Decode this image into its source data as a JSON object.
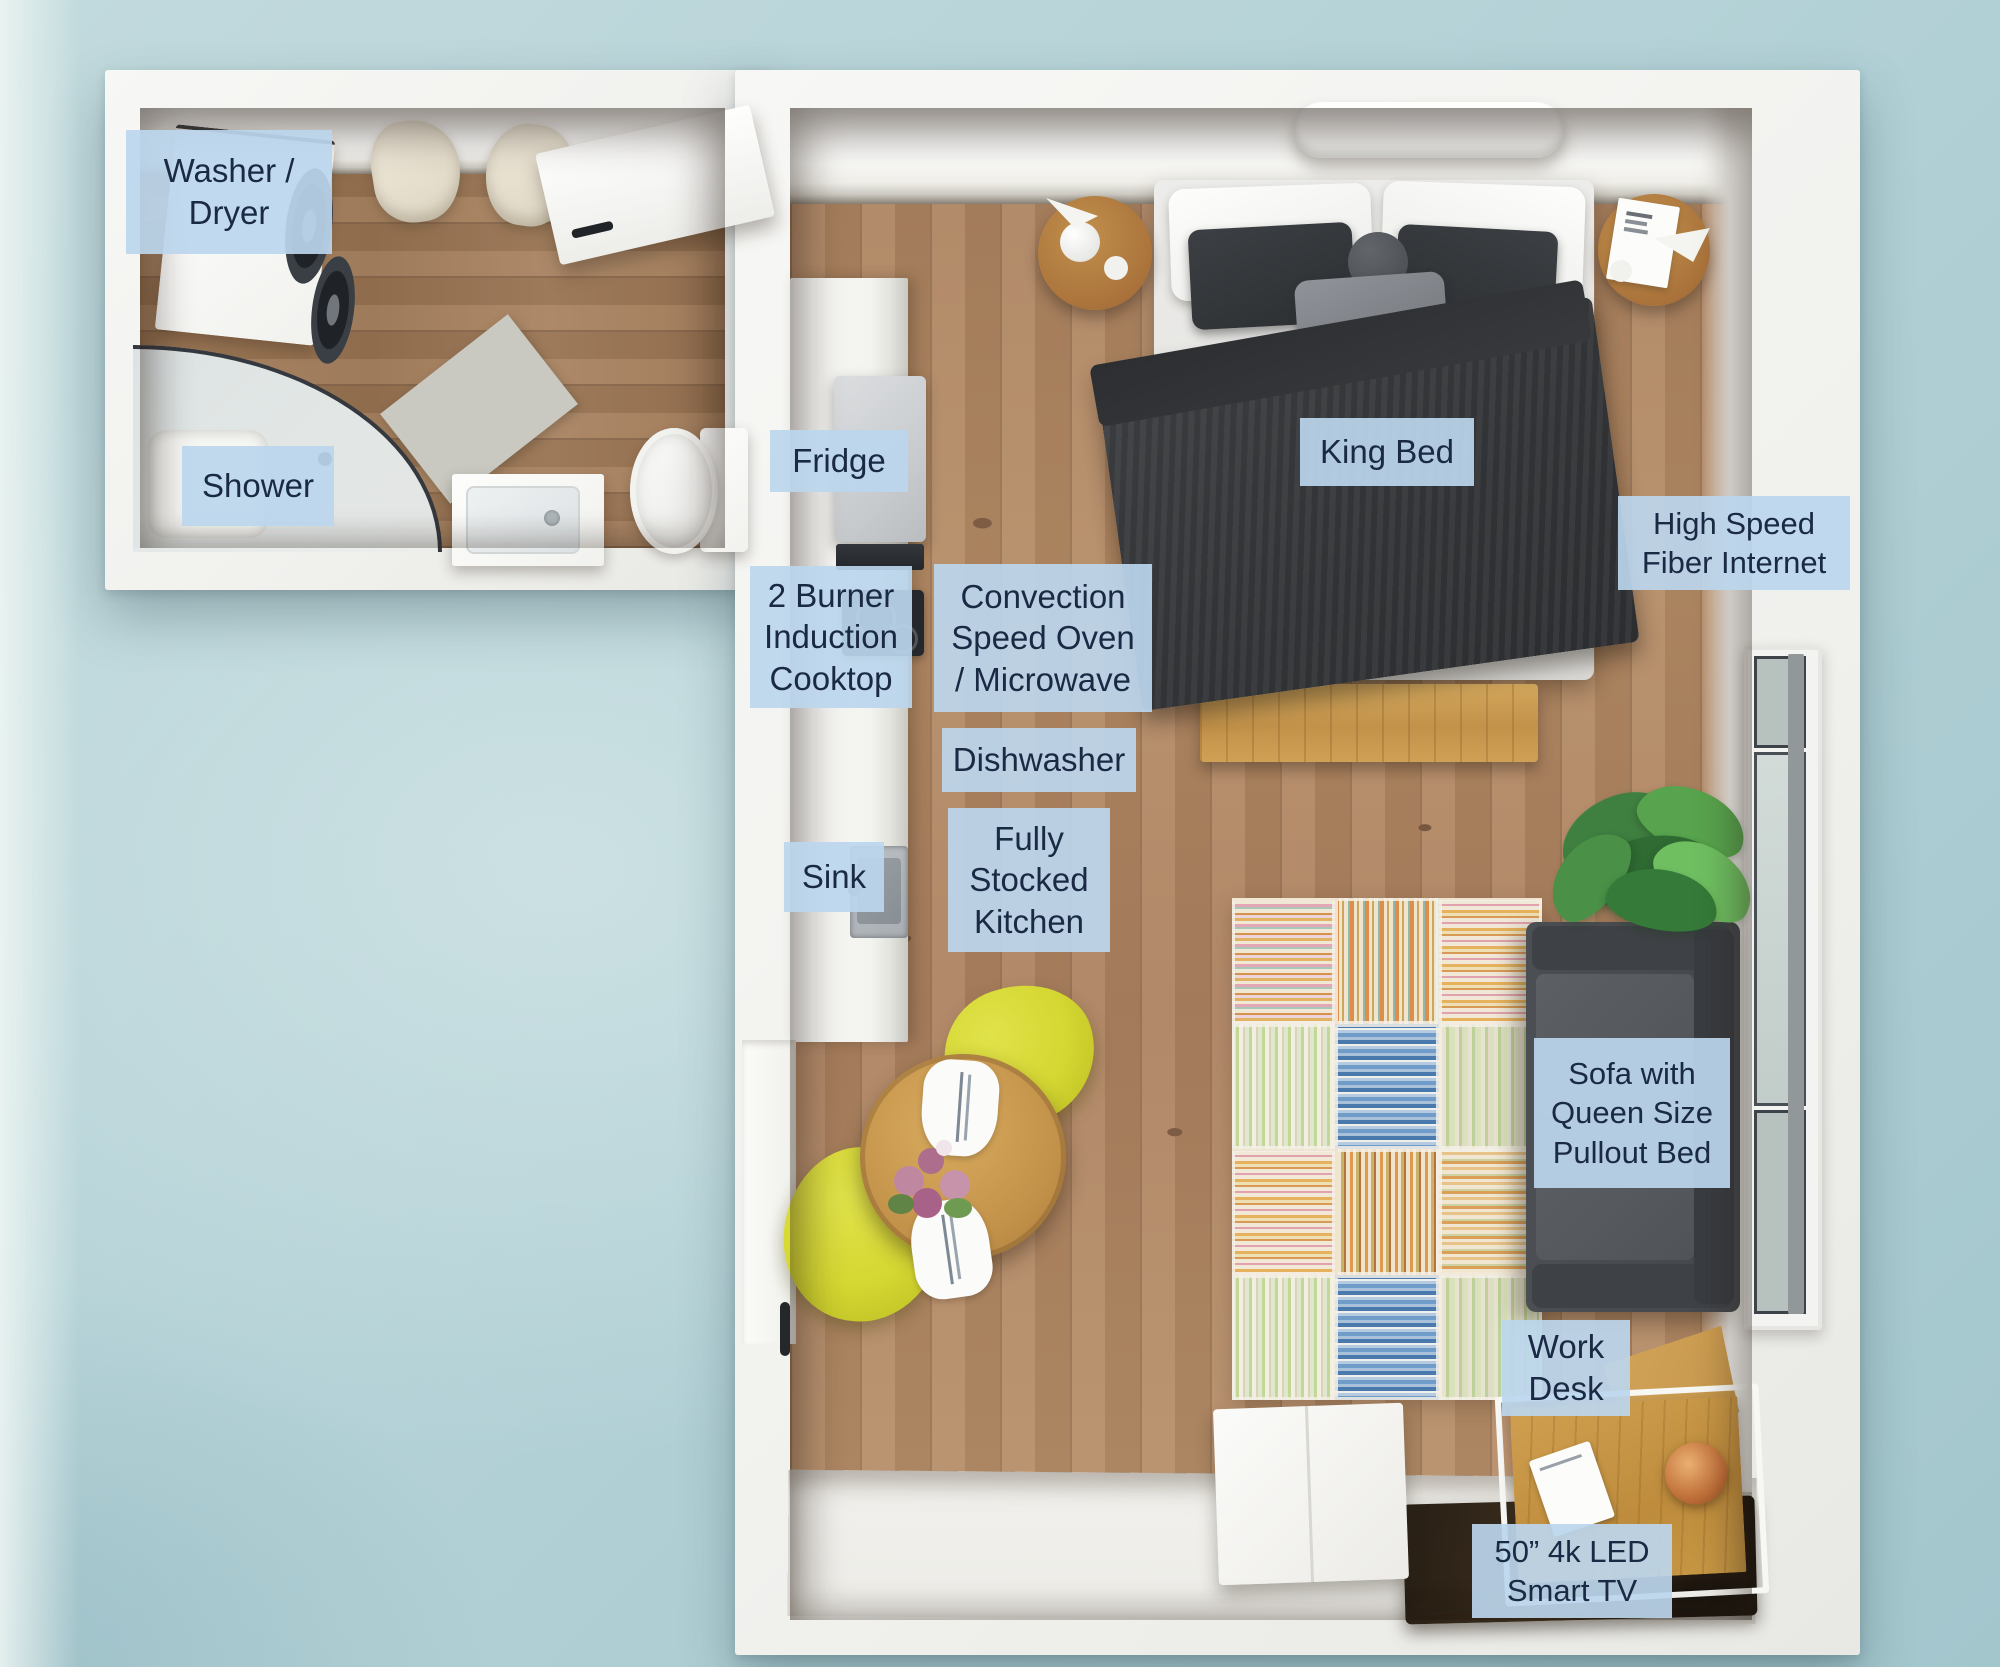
{
  "scene": {
    "type": "floor-plan",
    "rooms": [
      "bathroom-laundry",
      "studio-main-room"
    ]
  },
  "labels": {
    "washer_dryer": {
      "text": "Washer /\nDryer"
    },
    "shower": {
      "text": "Shower"
    },
    "fridge": {
      "text": "Fridge"
    },
    "cooktop": {
      "text": "2 Burner\nInduction\nCooktop"
    },
    "convection_oven": {
      "text": "Convection\nSpeed Oven\n/ Microwave"
    },
    "dishwasher": {
      "text": "Dishwasher"
    },
    "sink": {
      "text": "Sink"
    },
    "fully_stocked_kitchen": {
      "text": "Fully\nStocked\nKitchen"
    },
    "king_bed": {
      "text": "King Bed"
    },
    "fiber_internet": {
      "text": "High Speed\nFiber Internet"
    },
    "sofa_pullout": {
      "text": "Sofa with\nQueen Size\nPullout Bed"
    },
    "work_desk": {
      "text": "Work\nDesk"
    },
    "smart_tv": {
      "text": "50” 4k LED\nSmart TV"
    }
  },
  "colors": {
    "background_teal": "#b4d2d7",
    "wall_white": "#f4f3f0",
    "floor_wood_main": "#b58b65",
    "floor_wood_bath": "#a07a58",
    "label_background": "#bcd6ee",
    "label_text": "#1a2944",
    "sofa_gray": "#4b4e52",
    "duvet_charcoal": "#37393c",
    "chair_yellow": "#d6d82f",
    "bench_wood": "#c89c4e",
    "desk_wood": "#c08f3e",
    "plant_green": "#4a9147"
  }
}
